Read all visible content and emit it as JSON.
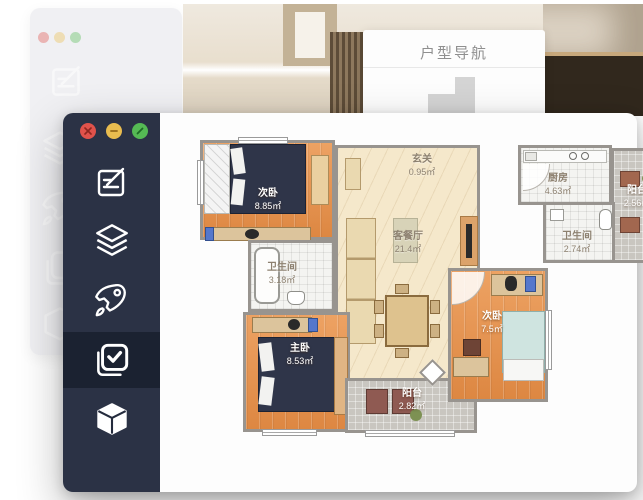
{
  "background": {
    "nav_panel_title": "户型导航",
    "mini_plan": "floor-plan-thumbnail"
  },
  "window": {
    "traffic_lights": [
      {
        "name": "close",
        "color": "#e0524b"
      },
      {
        "name": "minimize",
        "color": "#e9bc4f"
      },
      {
        "name": "zoom",
        "color": "#55ba54"
      }
    ],
    "sidebar": {
      "items": [
        {
          "id": "edit",
          "icon": "edit-note-icon",
          "active": false
        },
        {
          "id": "layers",
          "icon": "layers-icon",
          "active": false
        },
        {
          "id": "rocket",
          "icon": "rocket-icon",
          "active": false
        },
        {
          "id": "checklist",
          "icon": "checkbox-icon",
          "active": true
        },
        {
          "id": "model",
          "icon": "cube-icon",
          "active": false
        }
      ],
      "bg_color": "#2b3245",
      "active_bg_color": "#1b2231"
    }
  },
  "floor_plan": {
    "rooms": [
      {
        "name": "次卧",
        "area": "8.85㎡"
      },
      {
        "name": "玄关",
        "area": "0.95㎡"
      },
      {
        "name": "厨房",
        "area": "4.63㎡"
      },
      {
        "name": "阳台",
        "area": "2.56㎡"
      },
      {
        "name": "卫生间",
        "area": "2.74㎡"
      },
      {
        "name": "客餐厅",
        "area": "21.4㎡"
      },
      {
        "name": "卫生间",
        "area": "3.18㎡"
      },
      {
        "name": "主卧",
        "area": "8.53㎡"
      },
      {
        "name": "次卧",
        "area": "7.5㎡"
      },
      {
        "name": "阳台",
        "area": "2.82㎡"
      }
    ],
    "colors": {
      "wall": "#98948f",
      "wood_floor": "#e28e4d",
      "living_floor": "#f5e8cb",
      "gray_tile": "#c9c6c0",
      "white_tile": "#f4f4f1",
      "bed_navy": "#2f3549",
      "bed_blue": "#cfe4e0"
    }
  }
}
